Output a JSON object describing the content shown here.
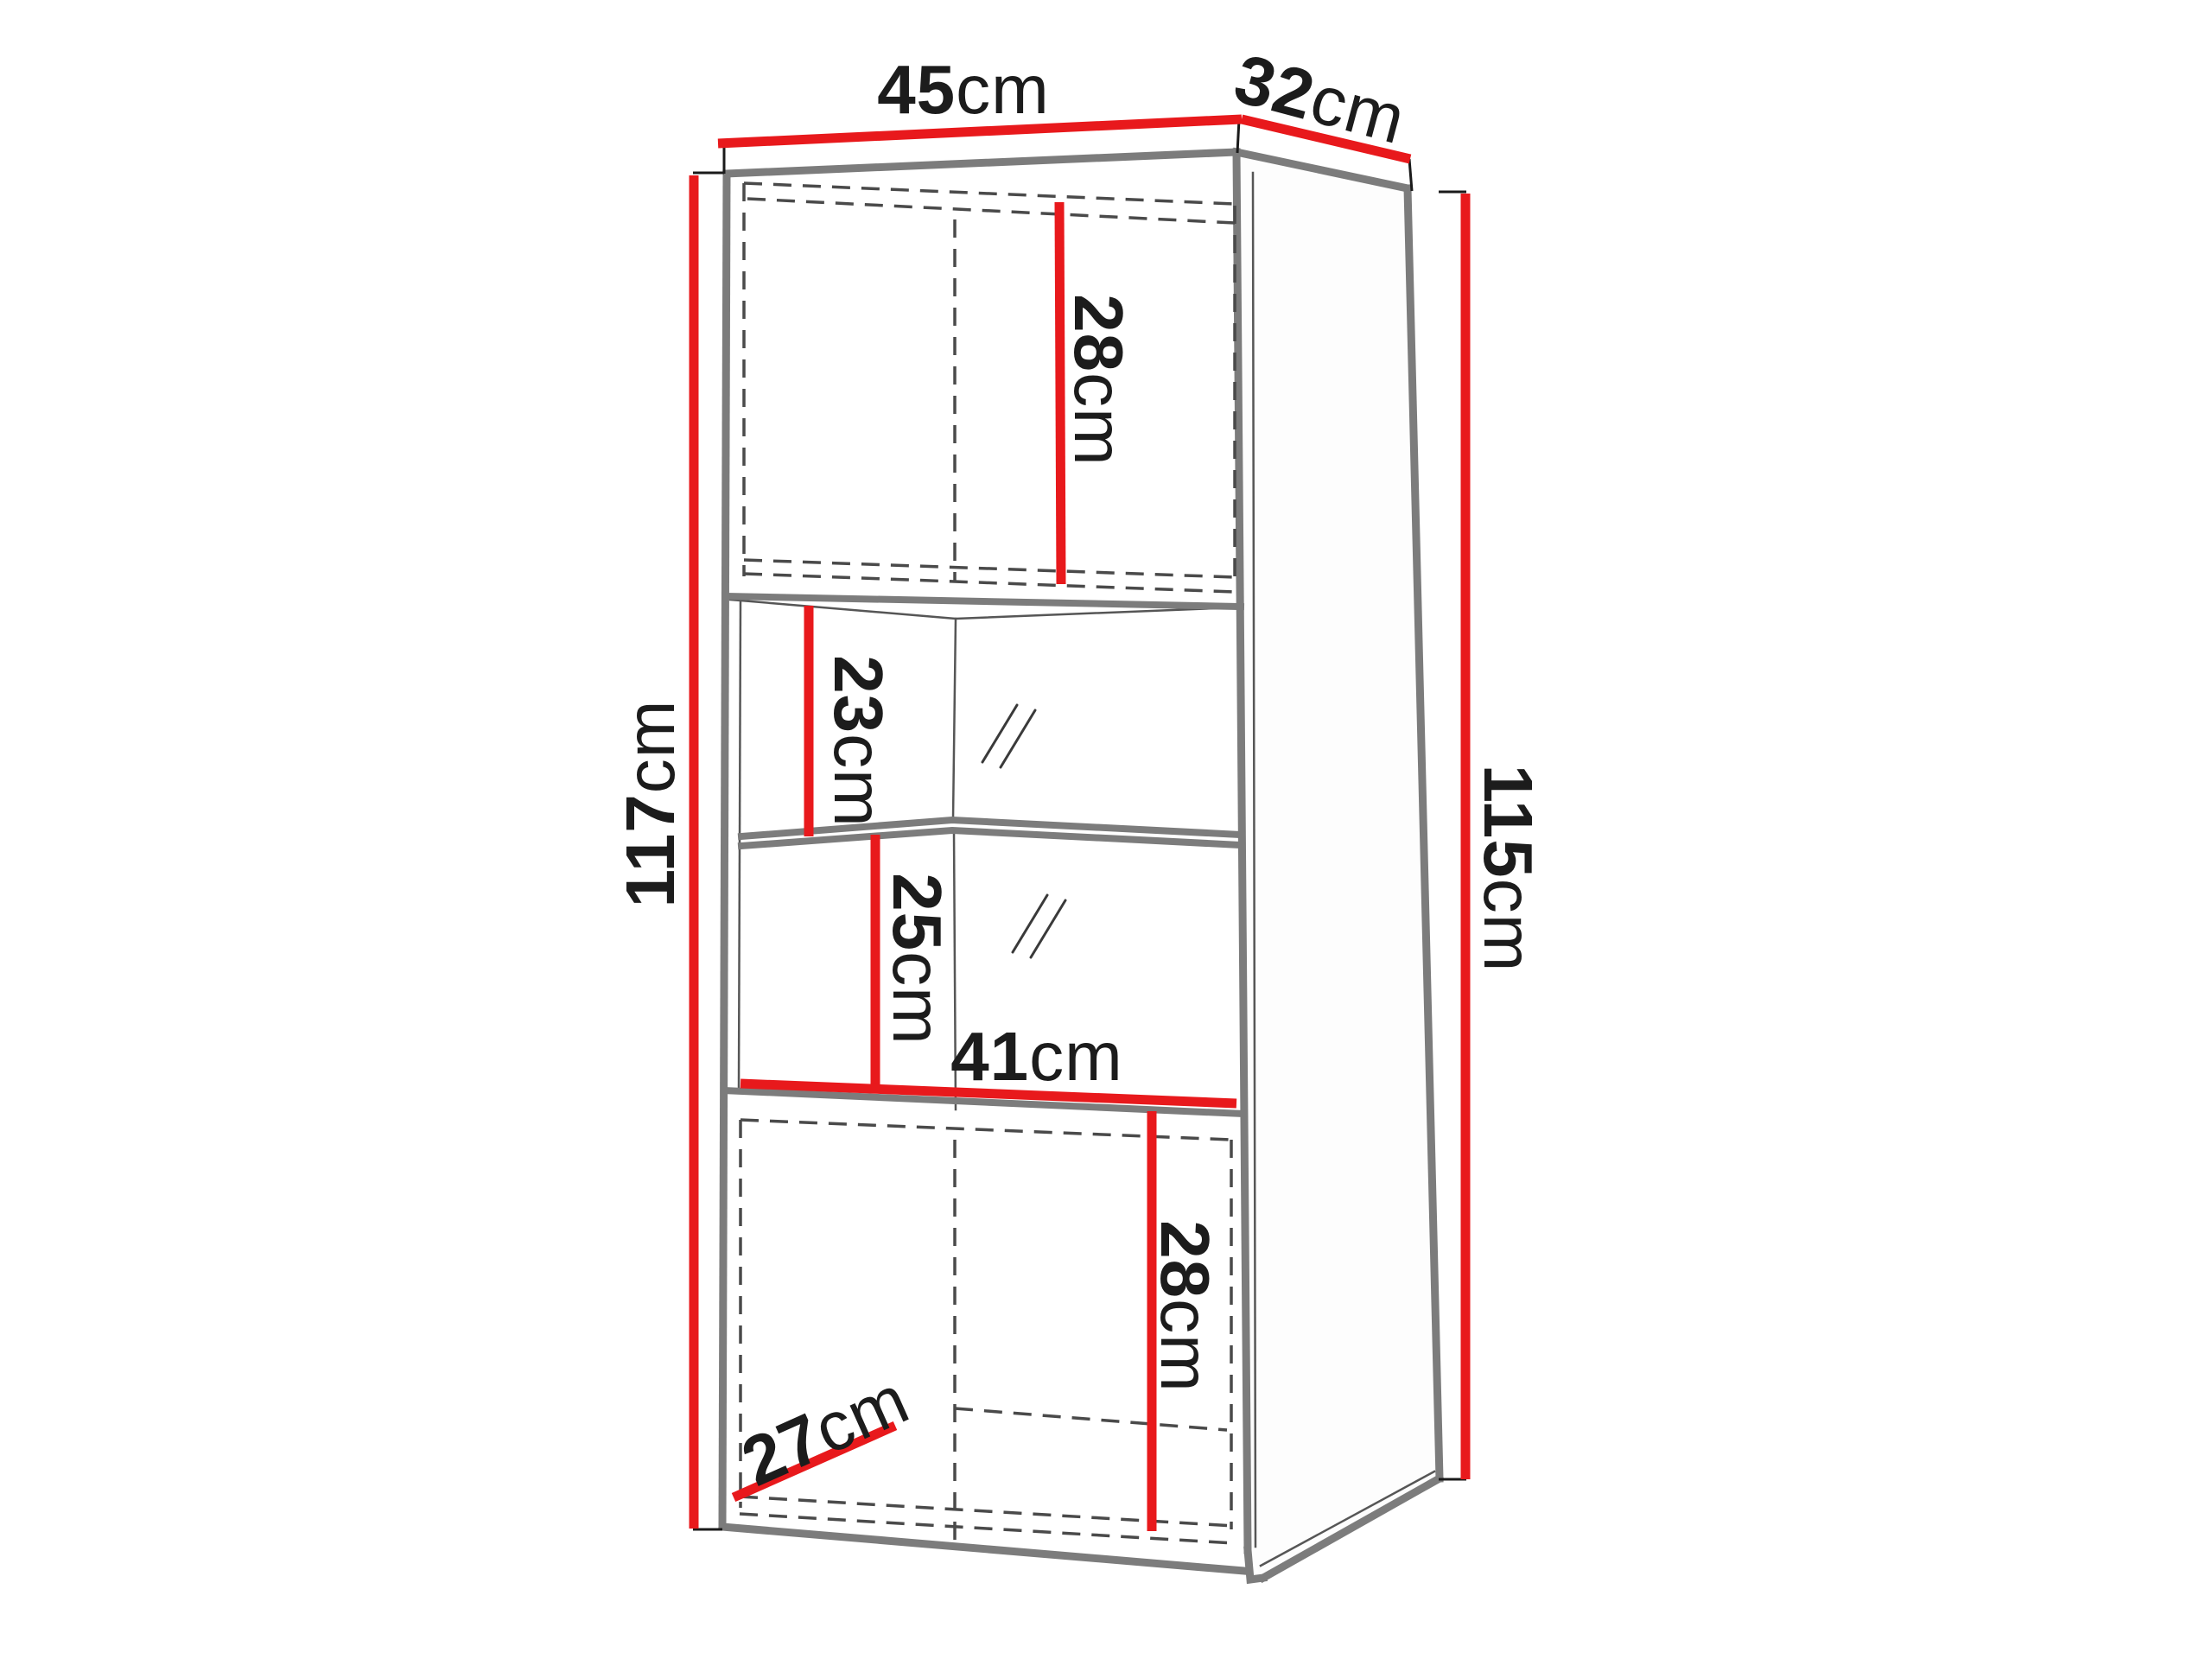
{
  "diagram": {
    "kind": "furniture-dimension-diagram",
    "subject": "tall display cabinet, 3-quarter perspective line drawing",
    "unit": "cm",
    "colors": {
      "dimension_line": "#e8191c",
      "cabinet_edge": "#7c7c7c",
      "hidden_line_dash": "#4a4a4a",
      "label_text": "#1c1c1c",
      "background": "#ffffff"
    },
    "labels": {
      "top_width": {
        "value": "45",
        "unit": "cm"
      },
      "top_depth": {
        "value": "32",
        "unit": "cm"
      },
      "left_height": {
        "value": "117",
        "unit": "cm"
      },
      "right_height": {
        "value": "115",
        "unit": "cm"
      },
      "upper_cabinet_height": {
        "value": "28",
        "unit": "cm"
      },
      "upper_shelf_gap": {
        "value": "23",
        "unit": "cm"
      },
      "lower_shelf_gap": {
        "value": "25",
        "unit": "cm"
      },
      "interior_width": {
        "value": "41",
        "unit": "cm"
      },
      "interior_depth": {
        "value": "27",
        "unit": "cm"
      },
      "lower_cabinet_height": {
        "value": "28",
        "unit": "cm"
      }
    }
  }
}
